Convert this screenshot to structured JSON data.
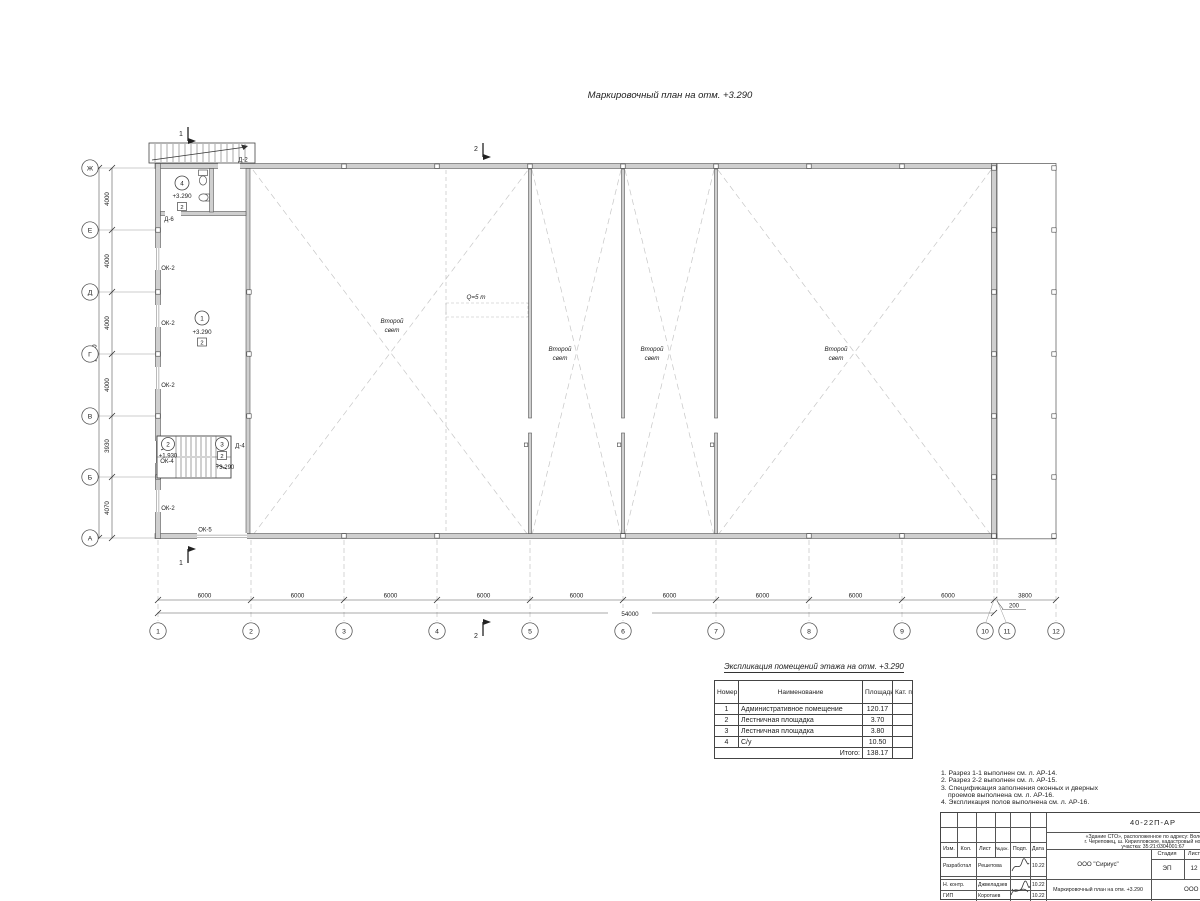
{
  "page": {
    "title": "Маркировочный план на отм. +3.290"
  },
  "plan": {
    "axis_letters": [
      "Ж",
      "Е",
      "Д",
      "Г",
      "В",
      "Б",
      "А"
    ],
    "axis_numbers": [
      "1",
      "2",
      "3",
      "4",
      "5",
      "6",
      "7",
      "8",
      "9",
      "10",
      "11",
      "12"
    ],
    "dims_left": [
      "4000",
      "4000",
      "4000",
      "4000",
      "3930",
      "4070"
    ],
    "dims_left_total": "24000",
    "dims_bottom": [
      "6000",
      "6000",
      "6000",
      "6000",
      "6000",
      "6000",
      "6000",
      "6000",
      "6000"
    ],
    "dim_200": "200",
    "dim_3800": "3800",
    "dims_bottom_total": "54000",
    "section_marks": {
      "s1": "1",
      "s2": "2"
    },
    "crane_label": "Q=5 т",
    "second_light": {
      "line1": "Второй",
      "line2": "свет"
    },
    "openings": {
      "ok2": "ОК-2",
      "ok4": "ОК-4",
      "ok5": "ОК-5",
      "d2": "Д-2",
      "d4": "Д-4",
      "d6": "Д-6"
    },
    "rooms": {
      "r1": {
        "num": "1",
        "elev": "+3.290",
        "cat": "2"
      },
      "r2": {
        "num": "2",
        "elev": "+1.930"
      },
      "r3": {
        "num": "3",
        "elev": "+3.290",
        "cat": "2"
      },
      "r4": {
        "num": "4",
        "elev": "+3.290",
        "cat": "2"
      }
    }
  },
  "table": {
    "title": "Экспликация помещений этажа на отм. +3.290",
    "headers": {
      "num": "Номер помещ.",
      "name": "Наименование",
      "area": "Площадь",
      "cat": "Кат. пом."
    },
    "rows": [
      {
        "num": "1",
        "name": "Административное помещение",
        "area": "120.17",
        "cat": ""
      },
      {
        "num": "2",
        "name": "Лестничная площадка",
        "area": "3.70",
        "cat": ""
      },
      {
        "num": "3",
        "name": "Лестничная площадка",
        "area": "3.80",
        "cat": ""
      },
      {
        "num": "4",
        "name": "С/у",
        "area": "10.50",
        "cat": ""
      }
    ],
    "total_label": "Итого:",
    "total_value": "138.17"
  },
  "notes": {
    "items": [
      "1. Разрез 1-1 выполнен см. л. АР-14.",
      "2. Разрез 2-2 выполнен см. л. АР-15.",
      "3. Спецификация заполнения оконных и дверных",
      "    проемов выполнена см. л. АР-16.",
      "4. Экспликация полов выполнена см. л. АР-16."
    ]
  },
  "stamp": {
    "doc_number": "40-22П-АР",
    "project_desc_1": "«Здание СТО», расположенное по адресу: Вологодская",
    "project_desc_2": "г. Череповец, ш. Кирилловское, кадастровый номер зем.",
    "project_desc_3": "участка: 35:21:0304001:67",
    "header_cols": [
      "Изм.",
      "Кол.",
      "Лист",
      "№док.",
      "Подп.",
      "Дата"
    ],
    "roles": [
      {
        "role": "Разработал",
        "name": "Решетова",
        "date": "10.22"
      },
      {
        "role": "Н. контр.",
        "name": "Джвеладзев",
        "date": "10.22"
      },
      {
        "role": "ГИП",
        "name": "Коротаев",
        "date": "10.22"
      }
    ],
    "org_top": "ООО \"Сириус\"",
    "drawing_title": "Маркировочный план на отм. +3.290",
    "org_bottom": "ООО \"Ал",
    "stage_label": "Стадия",
    "sheet_label": "Лист",
    "stage_value": "ЭП",
    "sheet_value": "12"
  }
}
